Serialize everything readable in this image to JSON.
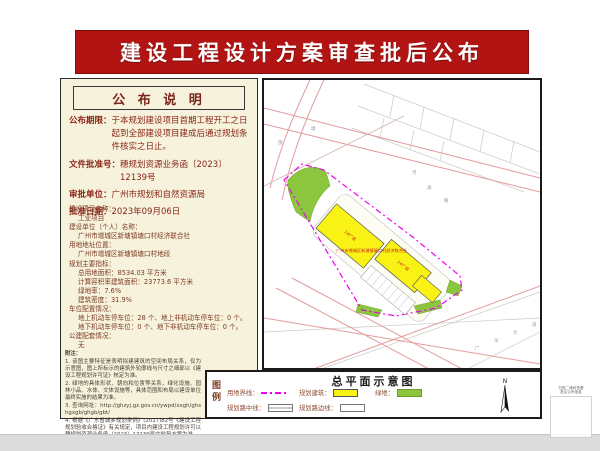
{
  "banner": {
    "title": "建设工程设计方案审查批后公布",
    "bg_color": "#b21414"
  },
  "notice": {
    "section_title": "公 布 说 明",
    "fields": [
      {
        "label": "公布期限：",
        "value": "于本规划建设项目首期工程开工之日起到全部建设项目建成后通过规划条件核实之日止。"
      },
      {
        "label": "文件批准号：",
        "value": "穗规划资源业务函〔2023〕12139号"
      },
      {
        "label": "审批单位：",
        "value": "广州市规划和自然资源局"
      },
      {
        "label": "批准日期：",
        "value": "2023年09月06日"
      }
    ]
  },
  "details": {
    "lines": [
      {
        "t": "建设项目名称：",
        "i": 0
      },
      {
        "t": "工业项目",
        "i": 1
      },
      {
        "t": "建设单位（个人）名称：",
        "i": 0
      },
      {
        "t": "广州市增城区新塘镇塘口村经济联合社",
        "i": 1
      },
      {
        "t": "用地地址位置：",
        "i": 0
      },
      {
        "t": "广州市增城区新塘镇塘口村地段",
        "i": 1
      },
      {
        "t": "规划主要指标：",
        "i": 0
      },
      {
        "t": "总用地面积：8534.03 平方米",
        "i": 1
      },
      {
        "t": "计算容积率建筑面积：23773.6 平方米",
        "i": 1
      },
      {
        "t": "绿地率：7.6%",
        "i": 1
      },
      {
        "t": "建筑密度：31.9%",
        "i": 1
      },
      {
        "t": "车位配置情况：",
        "i": 0
      },
      {
        "t": "地上机动车停车位：28 个、地上非机动车停车位：0 个。",
        "i": 1
      },
      {
        "t": "地下机动车停车位：0 个、地下非机动车停车位：0 个。",
        "i": 1
      },
      {
        "t": "公建配套情况：",
        "i": 0
      },
      {
        "t": "无",
        "i": 1
      }
    ]
  },
  "notes": {
    "title": "附注：",
    "items": [
      "1. 该图主要特征是表明拟建建筑的空间布局关系，仅为示意图，图上所标示的建筑外轮廓线与尺寸之细部以《建设工程规划许可证》核定为准。",
      "2. 绿地的具体形状、朝向和位置等关系，绿化设施、园林小品、水体、文体设施等，具体范围和布局以建设单位最终实施的结果为准。",
      "3. 查询网址：http://ghzyj.gz.gov.cn/ywpd/xxgh/ghshgxgb/ghgb/gbt/",
      "4. 根据《广东省城乡规划条例》(2017)82号《建设工程规划验收合格证》有关规定，项目内建设工程规划许可以穗规划资源业务函〔2023〕12139号文批复方案为准。"
    ]
  },
  "map": {
    "title": "总平面示意图",
    "company_label": "广州市增城区新塘镇塘口村经济联合社",
    "buildings": [
      {
        "label": "1#厂房"
      },
      {
        "label": "2#厂房"
      }
    ],
    "scatter_labels": [
      "塘",
      "围",
      "河",
      "涌",
      "路",
      "广",
      "深",
      "大",
      "道"
    ]
  },
  "legend": {
    "title": "图例",
    "items": [
      {
        "label": "用地界线：",
        "type": "boundary"
      },
      {
        "label": "规划建筑：",
        "type": "building"
      },
      {
        "label": "绿地：",
        "type": "green"
      },
      {
        "label": "规划路中线：",
        "type": "centerline"
      },
      {
        "label": "规划路边线：",
        "type": "edgeline"
      }
    ],
    "north_label": "N"
  },
  "qr": {
    "caption_line1": "扫描二维码查看",
    "caption_line2": "批后公布信息"
  },
  "colors": {
    "banner_bg": "#b21414",
    "panel_bg": "#f6f2dc",
    "accent_text": "#8a2418",
    "site_boundary": "#ee00ee",
    "building_fill": "#f8f315",
    "green_fill": "#8cc63f",
    "road_pink": "#e49c9c"
  }
}
